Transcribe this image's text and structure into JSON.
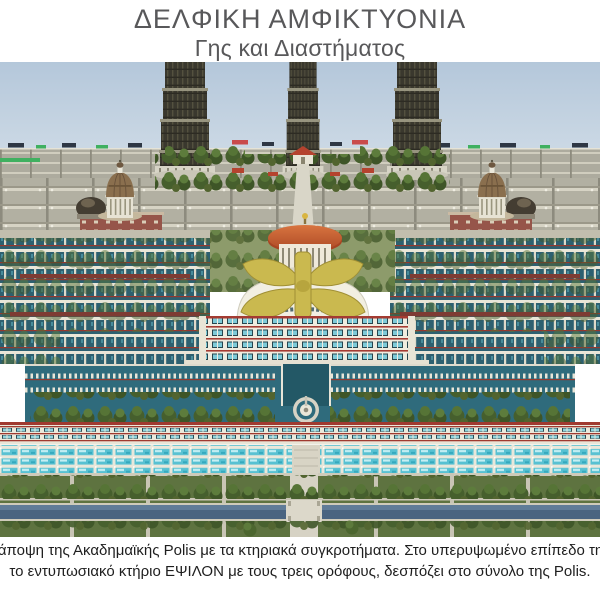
{
  "header": {
    "title": "ΔΕΛΦΙΚΗ ΑΜΦΙΚΤΥΟΝΙΑ",
    "subtitle": "Γης και Διαστήματος"
  },
  "caption": {
    "line1": "νική άποψη της Ακαδημαϊκής Polis με τα κτηριακά συγκροτήματα. Στο υπερυψωμένο επίπεδο της Po",
    "line2": "το εντυπωσιακό κτήριο ΕΨΙΛΟΝ με τους τρεις ορόφους, δεσπόζει στο σύνολο της Polis."
  },
  "figure": {
    "name": "academic-polis-render",
    "colors": {
      "sky_top": "#b4c7da",
      "sky_bottom": "#ccd9e5",
      "city_grid_gray": "#b2b0a2",
      "tower_dark": "#3a382e",
      "dome_bronze": "#8a6f4e",
      "brick_red": "#96554a",
      "rotunda_orange": "#c1562e",
      "epsilon_gold": "#cab94f",
      "water_teal": "#2f6b7c",
      "pool_cyan": "#58c1d2",
      "stripe_red": "#a33b32",
      "lawn_green": "#5e7340",
      "canal_blue": "#4a6480",
      "stone_path": "#d6d2c4",
      "tree_green": "#465f2d",
      "title_gray": "#58585a",
      "caption_black": "#1e1e1e"
    }
  }
}
